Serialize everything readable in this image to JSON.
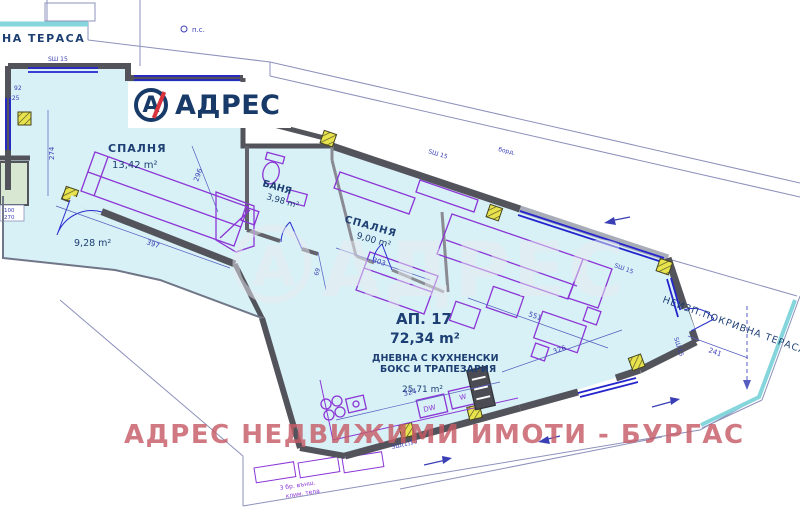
{
  "logo": {
    "brand": "АДРЕС",
    "monogram": "А"
  },
  "watermark": {
    "center": "АДРЕС",
    "bottom": "АДРЕС НЕДВИЖИМИ ИМОТИ - БУРГАС"
  },
  "plan": {
    "apartment_label": "АП. 17",
    "apartment_area": "72,34 m²",
    "rooms": {
      "bedroom1": {
        "name": "СПАЛНЯ",
        "area": "13,42 m²"
      },
      "bathroom": {
        "name": "БАНЯ",
        "area": "3,98 m²"
      },
      "bedroom2": {
        "name": "СПАЛНЯ",
        "area": "9,00 m²"
      },
      "living": {
        "name_line1": "ДНЕВНА С КУХНЕНСКИ",
        "name_line2": "БОКС И ТРАПЕЗАРИЯ",
        "area": "25,71 m²"
      },
      "terrace_left": {
        "area": "9,28 m²"
      },
      "terrace_right": {
        "name": "НЕИЗП.ПОКРИВНА ТЕРАСА"
      },
      "terrace_top": {
        "name": "НА ТЕРАСА"
      }
    },
    "dimensions": {
      "d274": "274",
      "d92": "92",
      "d225": "225",
      "d397": "397",
      "d296": "296",
      "d303": "303",
      "d551": "551",
      "d324": "324",
      "d326": "326",
      "d241": "241",
      "d100": "100",
      "d270": "270",
      "d69": "69"
    },
    "annotations": {
      "ps": "п.с.",
      "bord": "борд.",
      "sw15": "SШ 15",
      "sw110": "SШ(1)10",
      "dw": "DW",
      "w": "W",
      "ac_line1": "3 бр. външ.",
      "ac_line2": "клим. тела"
    },
    "colors": {
      "interior": "#d8f1f6",
      "wall": "#53535c",
      "window": "#2424cd",
      "terrace_edge": "#85d6dc",
      "furniture": "#8b35d6",
      "column": "#e8e34c",
      "label": "#1d3f73",
      "watermark_pink": "#c65c66",
      "brand_navy": "#173a69",
      "brand_red": "#d8323c"
    }
  }
}
